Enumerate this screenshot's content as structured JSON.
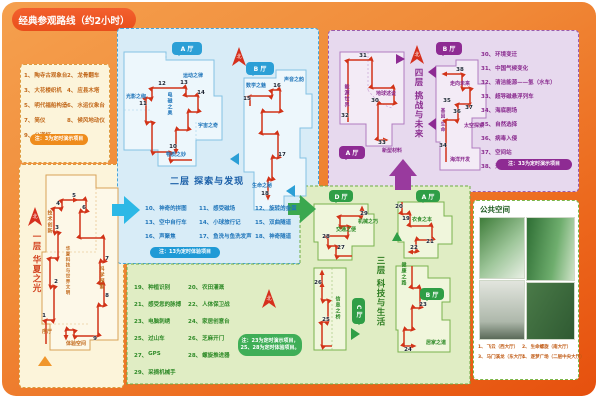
{
  "title": "经典参观路线（约2小时）",
  "compass": "北",
  "floor1": {
    "name": "一层 华夏之光",
    "legend": [
      {
        "no": "1、",
        "label": "陶寺古观象台"
      },
      {
        "no": "2、",
        "label": "龙骨翻车"
      },
      {
        "no": "3、",
        "label": "大花楼织机"
      },
      {
        "no": "4、",
        "label": "应县木塔"
      },
      {
        "no": "5、",
        "label": "明代福船构造"
      },
      {
        "no": "6、",
        "label": "水运仪象台"
      },
      {
        "no": "7、",
        "label": "简仪"
      },
      {
        "no": "8、",
        "label": "候风地动仪"
      },
      {
        "no": "9、",
        "label": "公道杯"
      }
    ],
    "note": "注：3为定时演示项目",
    "areas": {
      "jishu": "技术创新",
      "center": "华夏科技与世界文明",
      "kexue": "科学探索",
      "xuting": "序厅",
      "tiyan": "体验空间"
    },
    "stops": [
      "1",
      "2",
      "3",
      "4",
      "5",
      "6",
      "7",
      "8",
      "9"
    ]
  },
  "floor2": {
    "name": "二层 探索与发现",
    "halls": [
      "A 厅",
      "B 厅"
    ],
    "legend": [
      {
        "no": "10、",
        "label": "神奇的拼图"
      },
      {
        "no": "11、",
        "label": "感受磁场"
      },
      {
        "no": "12、",
        "label": "旋转的金蛋"
      },
      {
        "no": "13、",
        "label": "空中自行车"
      },
      {
        "no": "14、",
        "label": "小球旅行记"
      },
      {
        "no": "15、",
        "label": "双曲隧道"
      },
      {
        "no": "16、",
        "label": "声聚焦"
      },
      {
        "no": "17、",
        "label": "鱼洗与鱼洗发声"
      },
      {
        "no": "18、",
        "label": "神奇隧道"
      }
    ],
    "note": "注：13为定时体验项目",
    "areas": {
      "guangying": "光影之绚",
      "dianci": "电磁之奥",
      "yundong": "运动之律",
      "yuzhou": "宇宙之奇",
      "wuzhi": "物质之妙",
      "shuxue": "数学之魅",
      "shengyin": "声音之韵",
      "shengming": "生命之秘"
    },
    "stops": [
      "10",
      "11",
      "12",
      "13",
      "14",
      "15",
      "16",
      "17",
      "18"
    ]
  },
  "floor3": {
    "name": "三层 科技与生活",
    "halls": [
      "A 厅",
      "B 厅",
      "C 厅",
      "D 厅"
    ],
    "legend": [
      {
        "no": "19、",
        "label": "种植识别"
      },
      {
        "no": "20、",
        "label": "农田灌溉"
      },
      {
        "no": "21、",
        "label": "感受您的脉搏"
      },
      {
        "no": "22、",
        "label": "人体保卫战"
      },
      {
        "no": "23、",
        "label": "电脑刺绣"
      },
      {
        "no": "24、",
        "label": "家居创意台"
      },
      {
        "no": "25、",
        "label": "过山车"
      },
      {
        "no": "26、",
        "label": "芝麻开门"
      },
      {
        "no": "27、",
        "label": "GPS"
      },
      {
        "no": "28、",
        "label": "螺旋推进器"
      },
      {
        "no": "29、",
        "label": "采摘机械手"
      }
    ],
    "note_line1": "注：23为定时演示项目，",
    "note_line2": "25、28为定时体验项目。",
    "areas": {
      "jiaotong": "交通之便",
      "jixie": "机械之巧",
      "yishi": "衣食之本",
      "jiankang": "健康之路",
      "jujia": "居家之道",
      "xinxi": "信息之桥"
    },
    "stops": [
      "19",
      "20",
      "21",
      "22",
      "23",
      "24",
      "25",
      "26",
      "27",
      "28",
      "29"
    ]
  },
  "floor4": {
    "name": "四层 挑战与未来",
    "halls": [
      "A 厅",
      "B 厅"
    ],
    "legend": [
      {
        "no": "30、",
        "label": "环境变迁"
      },
      {
        "no": "31、",
        "label": "中国气候变化"
      },
      {
        "no": "32、",
        "label": "清洁能源——氢（水车）"
      },
      {
        "no": "33、",
        "label": "超导磁悬浮列车"
      },
      {
        "no": "34、",
        "label": "海底剧场"
      },
      {
        "no": "35、",
        "label": "自然选择"
      },
      {
        "no": "36、",
        "label": "病毒入侵"
      },
      {
        "no": "37、",
        "label": "空间站"
      },
      {
        "no": "38、",
        "label": "沟通世界"
      }
    ],
    "note": "注：33为定时演示项目",
    "areas": {
      "nengyuan": "能源世界",
      "diqiu": "地球述说",
      "xincai": "新型材料",
      "zouxiang": "走向未来",
      "jiyin": "基因·生命",
      "taikong": "太空探索",
      "haiyang": "海洋开发"
    },
    "stops": [
      "30",
      "31",
      "32",
      "33",
      "34",
      "35",
      "36",
      "37",
      "38"
    ]
  },
  "public": {
    "title": "公共空间",
    "captions": [
      {
        "no": "1、",
        "label": "飞云（西大厅）"
      },
      {
        "no": "2、",
        "label": "生命螺旋（南大厅）"
      },
      {
        "no": "3、",
        "label": "马门溪龙（东大厅）"
      },
      {
        "no": "4、",
        "label": "逐梦广场（二层中央大厅）"
      }
    ]
  }
}
